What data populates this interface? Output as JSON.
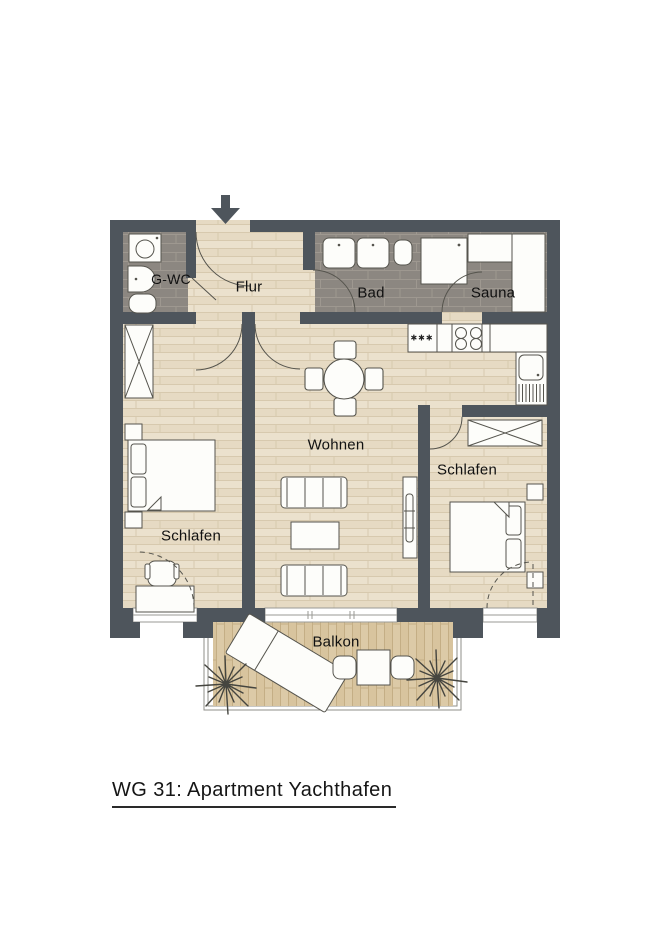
{
  "title": "WG 31: Apartment Yachthafen",
  "rooms": {
    "gwc": "G-WC",
    "flur": "Flur",
    "bad": "Bad",
    "sauna": "Sauna",
    "wohnen": "Wohnen",
    "schlafen_left": "Schlafen",
    "schlafen_right": "Schlafen",
    "balkon": "Balkon"
  },
  "kitchen": {
    "freezer_symbol": "✱✱✱"
  },
  "colors": {
    "wall": "#4e555c",
    "wood_floor": "#ebe1cd",
    "tile_floor": "#8c8781",
    "balcony_deck": "#d9c6a1",
    "outline": "#55544d",
    "label_text": "#111111"
  }
}
